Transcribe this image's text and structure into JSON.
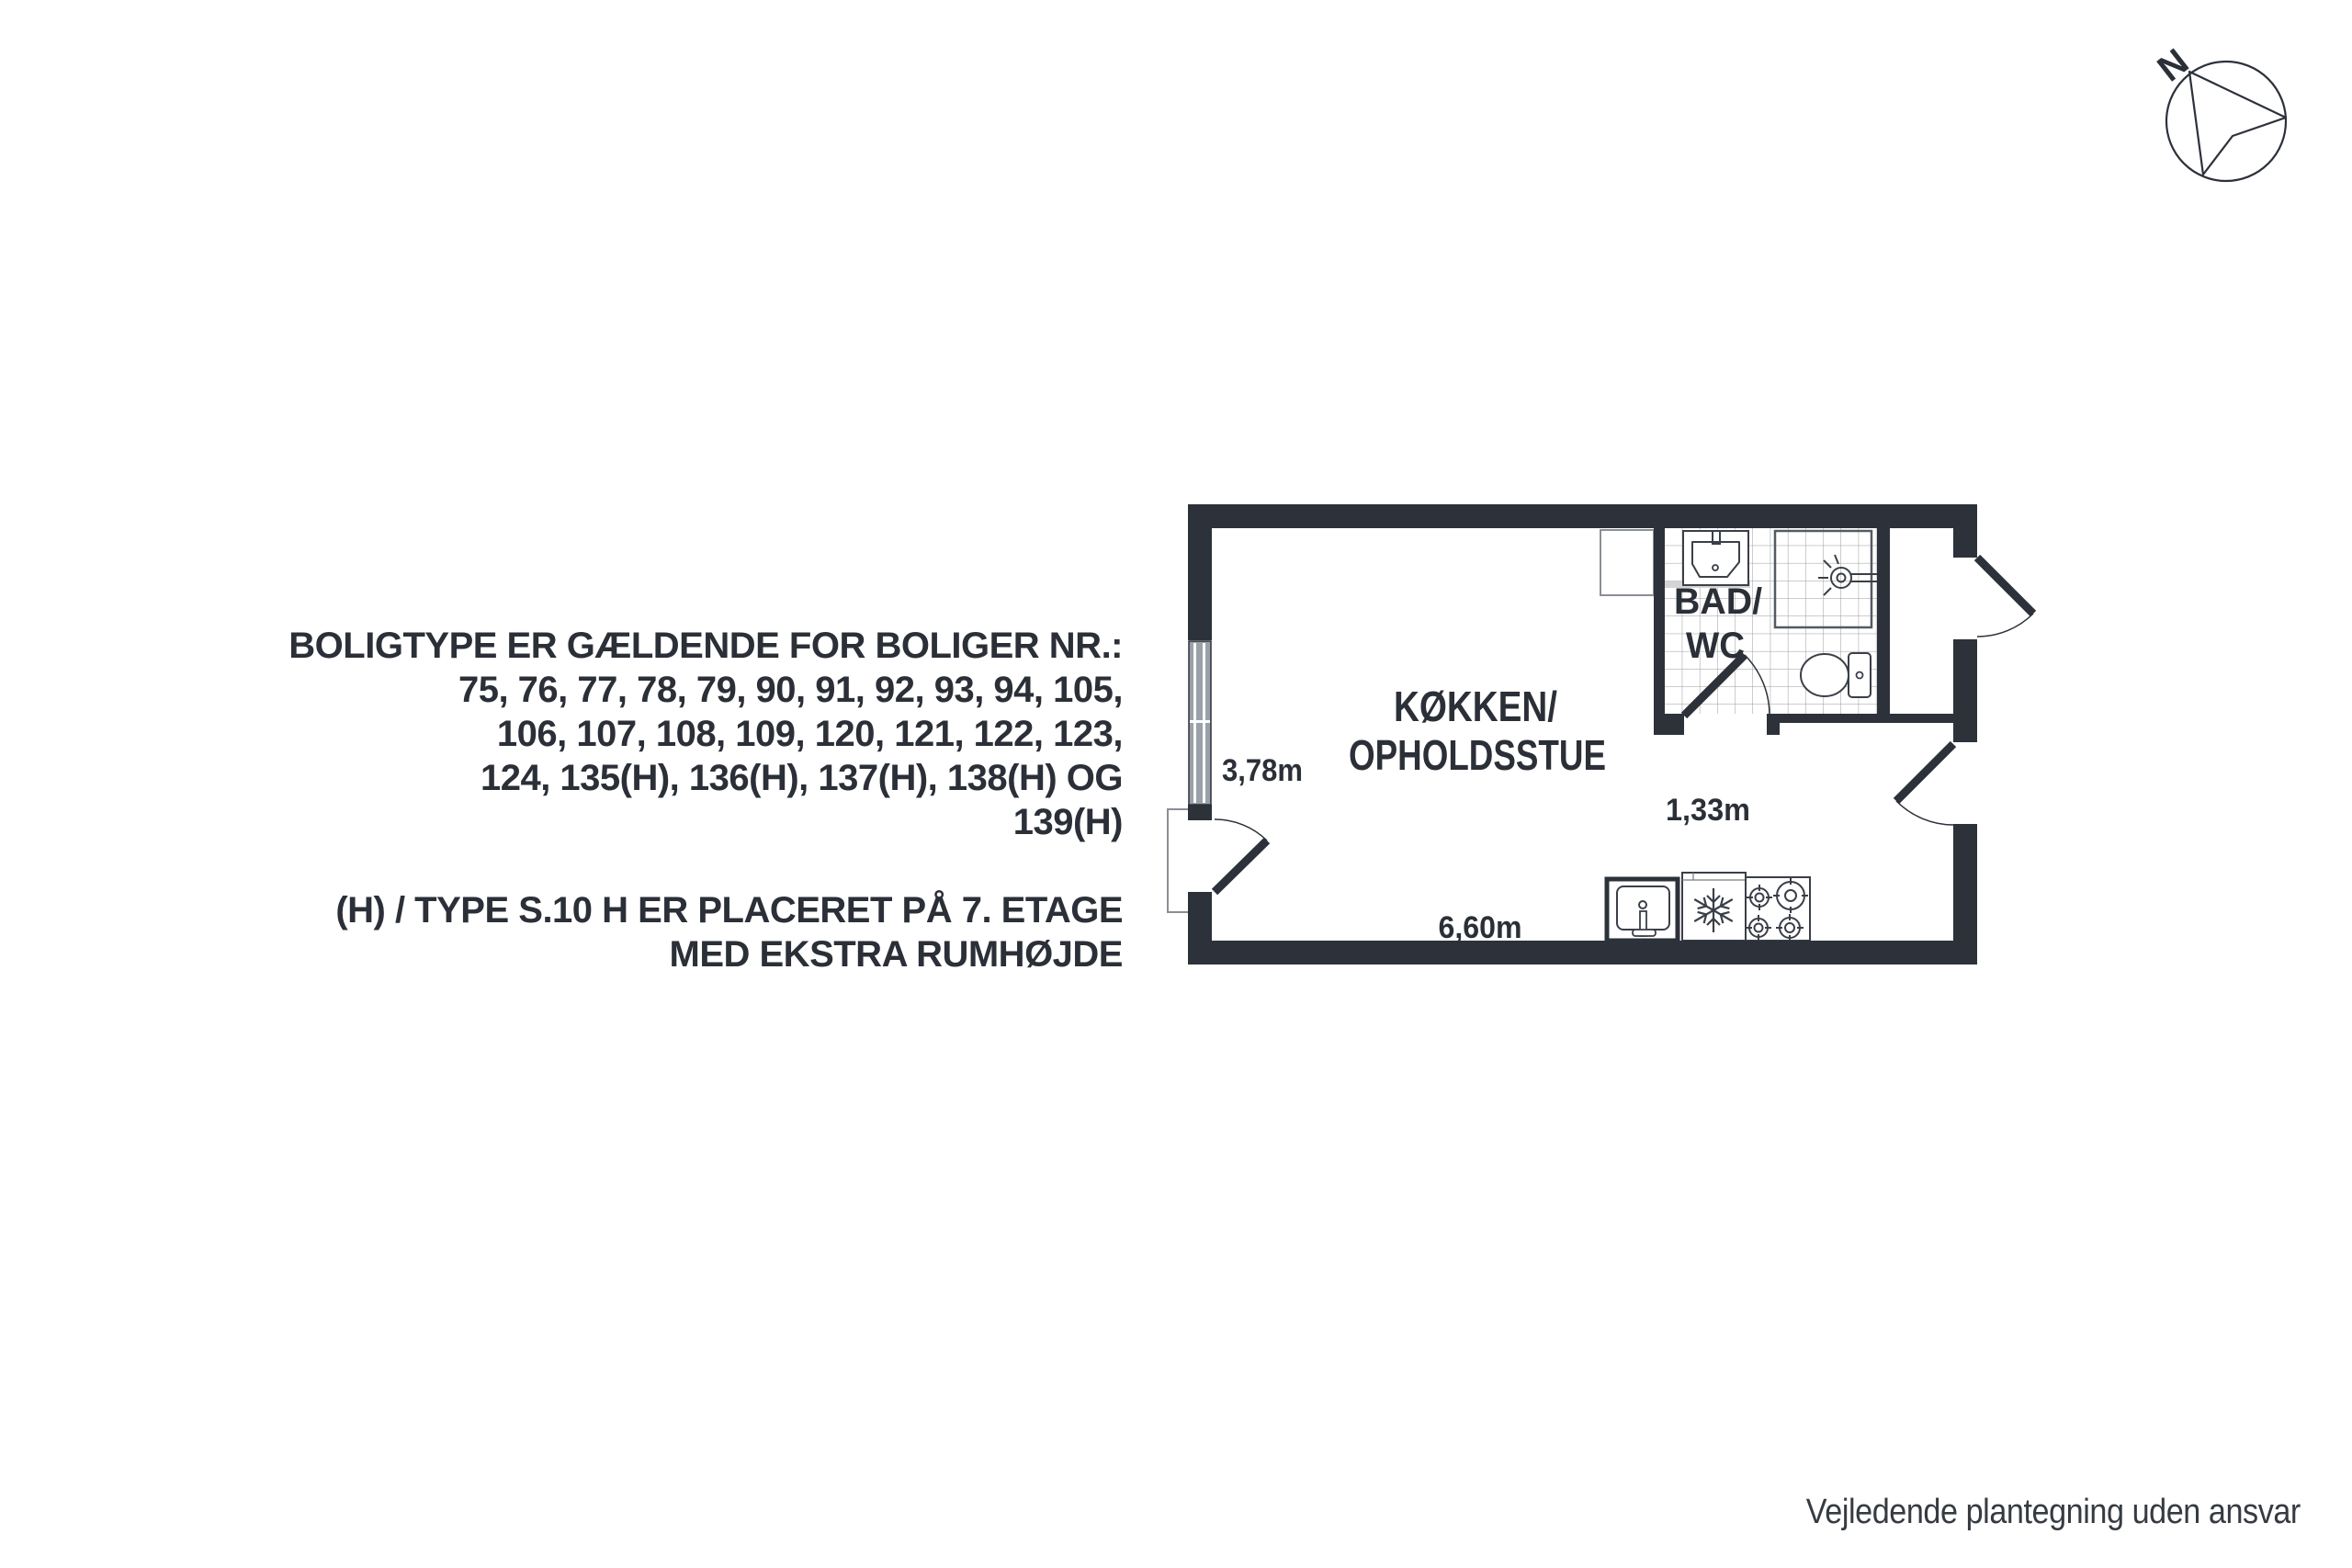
{
  "notes": {
    "para1": [
      "BOLIGTYPE ER GÆLDENDE FOR BOLIGER NR.:",
      "75, 76, 77, 78, 79, 90, 91, 92, 93, 94, 105,",
      "106, 107, 108, 109, 120, 121, 122, 123,",
      "124, 135(H), 136(H), 137(H), 138(H) OG",
      "139(H)"
    ],
    "para2": [
      "(H) / TYPE S.10 H ER PLACERET PÅ 7. ETAGE",
      "MED EKSTRA RUMHØJDE"
    ]
  },
  "plan": {
    "room_label_line1": "KØKKEN/",
    "room_label_line2": "OPHOLDSSTUE",
    "bath_label_line1": "BAD/",
    "bath_label_line2": "WC",
    "dim_left_wall": "3,78m",
    "dim_bath": "1,33m",
    "dim_bottom_wall": "6,60m"
  },
  "compass": {
    "north_label": "N"
  },
  "footer": {
    "disclaimer": "Vejledende plantegning uden ansvar"
  },
  "colors": {
    "wall": "#2c313a",
    "text": "#2b2f37",
    "window_fill": "#9ba1a8",
    "fixture_stroke": "#3a3f48",
    "tile_line": "#9a9a9a",
    "light_outline": "#8a8f96"
  }
}
